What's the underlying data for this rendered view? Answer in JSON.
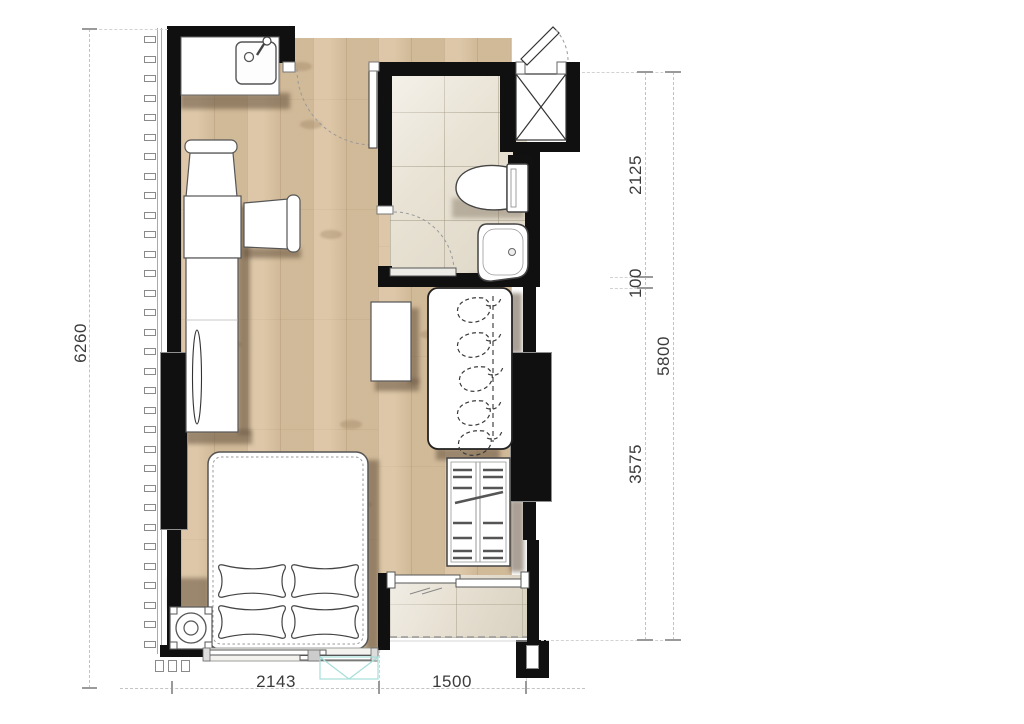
{
  "plan": {
    "dimensions": {
      "left": {
        "total": "6260"
      },
      "right": {
        "segments": [
          "2125",
          "100",
          "3575"
        ],
        "total": "5800"
      },
      "bottom": {
        "segments": [
          "2143",
          "1500"
        ]
      }
    },
    "colors": {
      "wall": "#101010",
      "wood_floor": "#d9c19e",
      "bathroom_tile": "#e9e3d5",
      "balcony_tile": "#e6dfd1",
      "glass": "#9fd9d4",
      "shadow": "#65523e",
      "dimension_text": "#3b3b3b"
    }
  }
}
